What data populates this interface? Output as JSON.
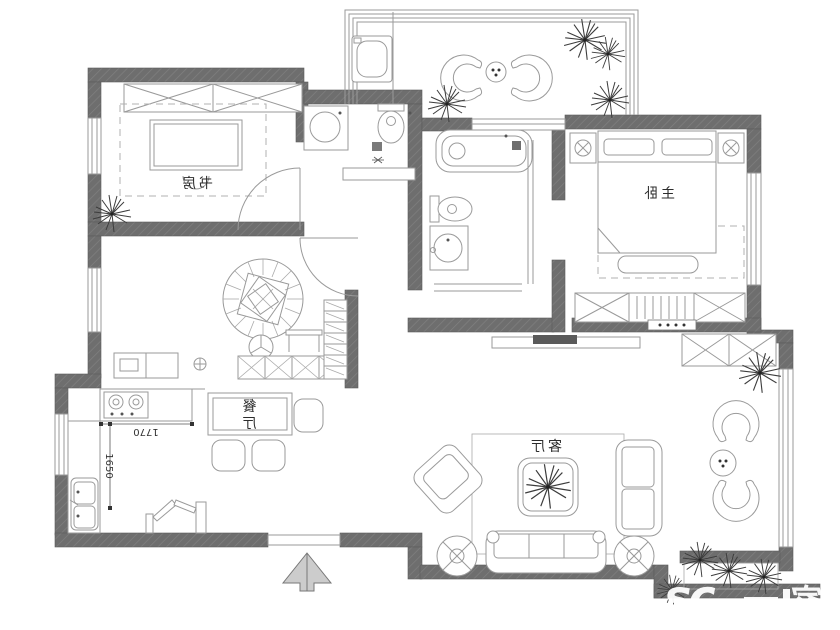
{
  "rooms": {
    "study": "书房",
    "master_bedroom": "主卧",
    "dining_char1": "餐",
    "dining_char2": "厅",
    "living": "客厅"
  },
  "dimensions": {
    "kitchen_width": "1770",
    "kitchen_depth": "1650"
  },
  "watermark": {
    "prefix": "sc",
    "suffix": "家"
  },
  "colors": {
    "wall": "#6e6e6e",
    "fixture_line": "#9a9a9a",
    "watermark": "#ffffff"
  }
}
